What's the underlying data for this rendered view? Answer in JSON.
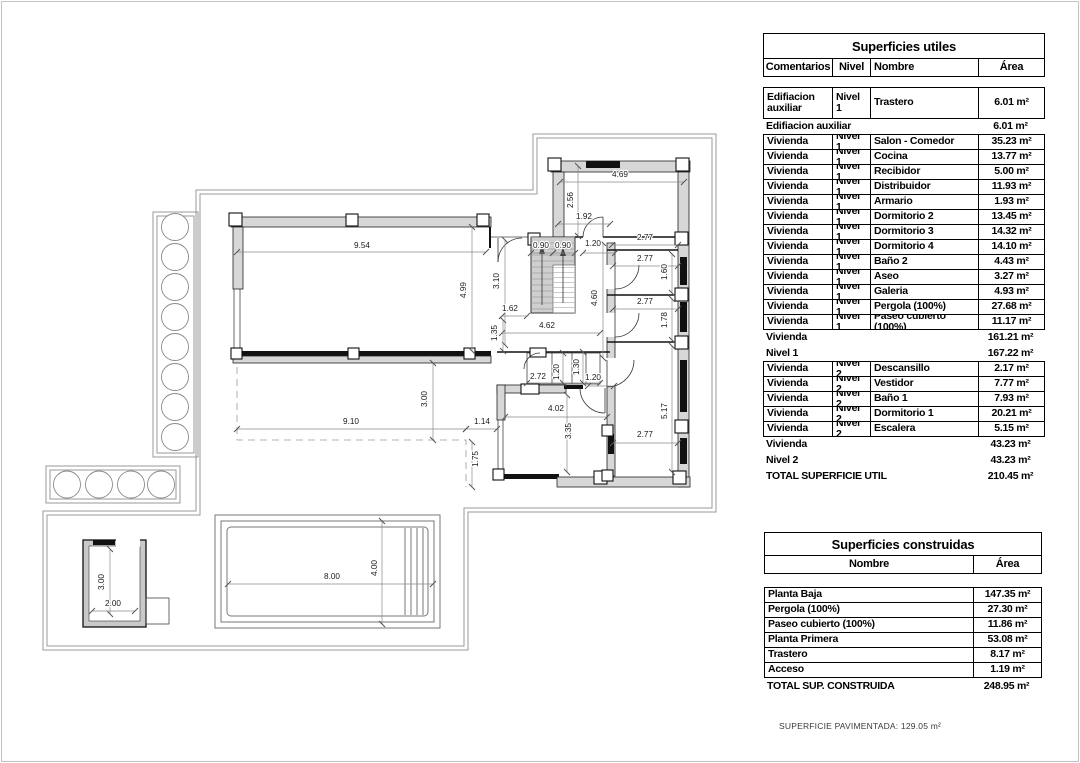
{
  "plan": {
    "dimensions": [
      {
        "t": "9.54",
        "x": 362,
        "y": 248,
        "r": 0
      },
      {
        "t": "4.99",
        "x": 466,
        "y": 290,
        "r": -90
      },
      {
        "t": "3.10",
        "x": 499,
        "y": 281,
        "r": -90
      },
      {
        "t": "4.69",
        "x": 620,
        "y": 177,
        "r": 0
      },
      {
        "t": "2.56",
        "x": 573,
        "y": 200,
        "r": -90
      },
      {
        "t": "1.92",
        "x": 584,
        "y": 219,
        "r": 0
      },
      {
        "t": "0.90",
        "x": 541,
        "y": 248,
        "r": 0
      },
      {
        "t": "0.90",
        "x": 563,
        "y": 248,
        "r": 0
      },
      {
        "t": "1.20",
        "x": 593,
        "y": 246,
        "r": 0
      },
      {
        "t": "2.77",
        "x": 645,
        "y": 240,
        "r": 0
      },
      {
        "t": "2.77",
        "x": 645,
        "y": 261,
        "r": 0
      },
      {
        "t": "1.60",
        "x": 667,
        "y": 272,
        "r": -90
      },
      {
        "t": "2.77",
        "x": 645,
        "y": 304,
        "r": 0
      },
      {
        "t": "1.78",
        "x": 667,
        "y": 320,
        "r": -90
      },
      {
        "t": "4.60",
        "x": 597,
        "y": 298,
        "r": -90
      },
      {
        "t": "1.62",
        "x": 510,
        "y": 311,
        "r": 0
      },
      {
        "t": "4.62",
        "x": 547,
        "y": 328,
        "r": 0
      },
      {
        "t": "1.35",
        "x": 497,
        "y": 333,
        "r": -90
      },
      {
        "t": "2.72",
        "x": 538,
        "y": 379,
        "r": 0
      },
      {
        "t": "1.20",
        "x": 559,
        "y": 372,
        "r": -90
      },
      {
        "t": "1.30",
        "x": 579,
        "y": 367,
        "r": -90
      },
      {
        "t": "1.20",
        "x": 593,
        "y": 380,
        "r": 0
      },
      {
        "t": "4.02",
        "x": 556,
        "y": 411,
        "r": 0
      },
      {
        "t": "3.35",
        "x": 571,
        "y": 431,
        "r": -90
      },
      {
        "t": "2.77",
        "x": 645,
        "y": 437,
        "r": 0
      },
      {
        "t": "5.17",
        "x": 667,
        "y": 411,
        "r": -90
      },
      {
        "t": "3.00",
        "x": 427,
        "y": 399,
        "r": -90
      },
      {
        "t": "9.10",
        "x": 351,
        "y": 424,
        "r": 0
      },
      {
        "t": "1.14",
        "x": 482,
        "y": 424,
        "r": 0
      },
      {
        "t": "1.75",
        "x": 478,
        "y": 459,
        "r": -90
      },
      {
        "t": "3.00",
        "x": 104,
        "y": 582,
        "r": -90
      },
      {
        "t": "2.00",
        "x": 113,
        "y": 606,
        "r": 0
      },
      {
        "t": "8.00",
        "x": 332,
        "y": 579,
        "r": 0
      },
      {
        "t": "4.00",
        "x": 377,
        "y": 568,
        "r": -90
      }
    ]
  },
  "tables": {
    "utiles": {
      "title": "Superficies utiles",
      "columns": [
        "Comentarios",
        "Nivel",
        "Nombre",
        "Área"
      ],
      "rows": [
        {
          "type": "data",
          "tall": true,
          "c": "Edifiacion auxiliar",
          "n": "Nivel 1",
          "name": "Trastero",
          "area": "6.01 m²"
        },
        {
          "type": "subtotal",
          "label": "Edifiacion auxiliar",
          "area": "6.01 m²"
        },
        {
          "type": "data",
          "c": "Vivienda",
          "n": "Nivel 1",
          "name": "Salon - Comedor",
          "area": "35.23 m²"
        },
        {
          "type": "data",
          "c": "Vivienda",
          "n": "Nivel 1",
          "name": "Cocina",
          "area": "13.77 m²"
        },
        {
          "type": "data",
          "c": "Vivienda",
          "n": "Nivel 1",
          "name": "Recibidor",
          "area": "5.00 m²"
        },
        {
          "type": "data",
          "c": "Vivienda",
          "n": "Nivel 1",
          "name": "Distribuidor",
          "area": "11.93 m²"
        },
        {
          "type": "data",
          "c": "Vivienda",
          "n": "Nivel 1",
          "name": "Armario",
          "area": "1.93 m²"
        },
        {
          "type": "data",
          "c": "Vivienda",
          "n": "Nivel 1",
          "name": "Dormitorio 2",
          "area": "13.45 m²"
        },
        {
          "type": "data",
          "c": "Vivienda",
          "n": "Nivel 1",
          "name": "Dormitorio 3",
          "area": "14.32 m²"
        },
        {
          "type": "data",
          "c": "Vivienda",
          "n": "Nivel 1",
          "name": "Dormitorio 4",
          "area": "14.10 m²"
        },
        {
          "type": "data",
          "c": "Vivienda",
          "n": "Nivel 1",
          "name": "Baño 2",
          "area": "4.43 m²"
        },
        {
          "type": "data",
          "c": "Vivienda",
          "n": "Nivel 1",
          "name": "Aseo",
          "area": "3.27 m²"
        },
        {
          "type": "data",
          "c": "Vivienda",
          "n": "Nivel 1",
          "name": "Galeria",
          "area": "4.93 m²"
        },
        {
          "type": "data",
          "c": "Vivienda",
          "n": "Nivel 1",
          "name": "Pergola (100%)",
          "area": "27.68 m²"
        },
        {
          "type": "data",
          "c": "Vivienda",
          "n": "Nivel 1",
          "name": "Paseo cubierto (100%)",
          "area": "11.17 m²"
        },
        {
          "type": "subtotal",
          "label": "Vivienda",
          "area": "161.21 m²"
        },
        {
          "type": "subtotal",
          "label": "Nivel 1",
          "area": "167.22 m²"
        },
        {
          "type": "data",
          "c": "Vivienda",
          "n": "Nivel 2",
          "name": "Descansillo",
          "area": "2.17 m²"
        },
        {
          "type": "data",
          "c": "Vivienda",
          "n": "Nivel 2",
          "name": "Vestidor",
          "area": "7.77 m²"
        },
        {
          "type": "data",
          "c": "Vivienda",
          "n": "Nivel 2",
          "name": "Baño 1",
          "area": "7.93 m²"
        },
        {
          "type": "data",
          "c": "Vivienda",
          "n": "Nivel 2",
          "name": "Dormitorio 1",
          "area": "20.21 m²"
        },
        {
          "type": "data",
          "c": "Vivienda",
          "n": "Nivel 2",
          "name": "Escalera",
          "area": "5.15 m²"
        },
        {
          "type": "subtotal",
          "label": "Vivienda",
          "area": "43.23 m²"
        },
        {
          "type": "subtotal",
          "label": "Nivel 2",
          "area": "43.23 m²"
        },
        {
          "type": "subtotal",
          "label": "TOTAL SUPERFICIE UTIL",
          "area": "210.45 m²"
        }
      ]
    },
    "construidas": {
      "title": "Superficies construidas",
      "columns": [
        "Nombre",
        "Área"
      ],
      "rows": [
        {
          "type": "data",
          "name": "Planta Baja",
          "area": "147.35 m²"
        },
        {
          "type": "data",
          "name": "Pergola (100%)",
          "area": "27.30 m²"
        },
        {
          "type": "data",
          "name": "Paseo cubierto (100%)",
          "area": "11.86 m²"
        },
        {
          "type": "data",
          "name": "Planta Primera",
          "area": "53.08 m²"
        },
        {
          "type": "data",
          "name": "Trastero",
          "area": "8.17 m²"
        },
        {
          "type": "data",
          "name": "Acceso",
          "area": "1.19 m²"
        },
        {
          "type": "subtotal",
          "label": "TOTAL SUP. CONSTRUIDA",
          "area": "248.95 m²"
        }
      ]
    },
    "footer_note": "SUPERFICIE PAVIMENTADA: 129.05 m²"
  }
}
